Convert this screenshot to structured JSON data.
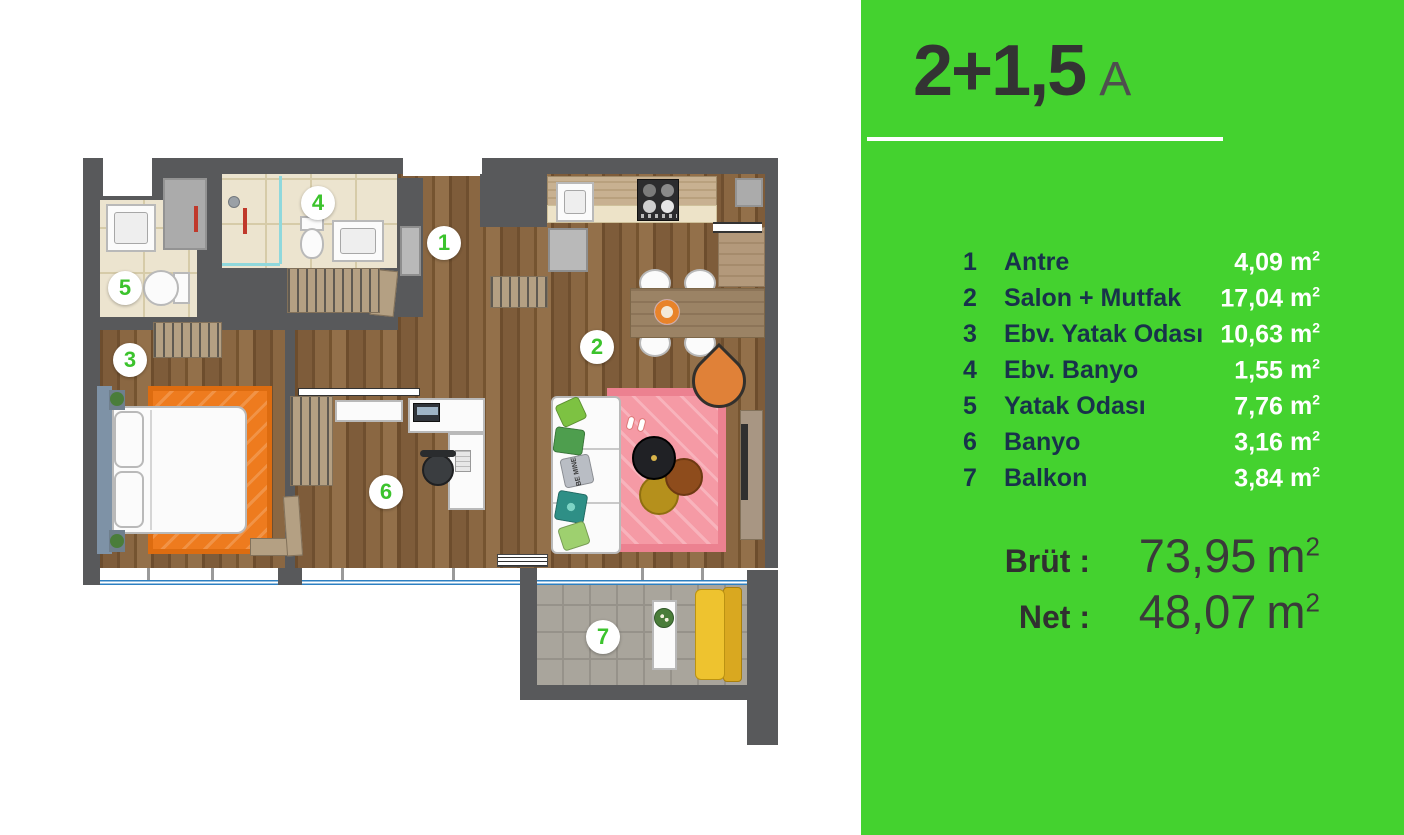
{
  "panel": {
    "title": "2+1,5",
    "title_suffix": "A",
    "unit": "m",
    "unit_sup": "2",
    "rooms": [
      {
        "num": "1",
        "name": "Antre",
        "area": "4,09"
      },
      {
        "num": "2",
        "name": "Salon + Mutfak",
        "area": "17,04"
      },
      {
        "num": "3",
        "name": "Ebv. Yatak Odası",
        "area": "10,63"
      },
      {
        "num": "4",
        "name": "Ebv. Banyo",
        "area": "1,55"
      },
      {
        "num": "5",
        "name": "Yatak Odası",
        "area": "7,76"
      },
      {
        "num": "6",
        "name": "Banyo",
        "area": "3,16"
      },
      {
        "num": "7",
        "name": "Balkon",
        "area": "3,84"
      }
    ],
    "totals": [
      {
        "label": "Brüt :",
        "value": "73,95"
      },
      {
        "label": "Net :",
        "value": "48,07"
      }
    ],
    "colors": {
      "green": "#44d22f",
      "navy": "#18324b",
      "dark": "#333333",
      "white": "#ffffff"
    }
  },
  "plan": {
    "markers": [
      {
        "num": "1"
      },
      {
        "num": "2"
      },
      {
        "num": "3"
      },
      {
        "num": "4"
      },
      {
        "num": "5"
      },
      {
        "num": "6"
      },
      {
        "num": "7"
      }
    ],
    "pillow_text": "BE MINE"
  }
}
